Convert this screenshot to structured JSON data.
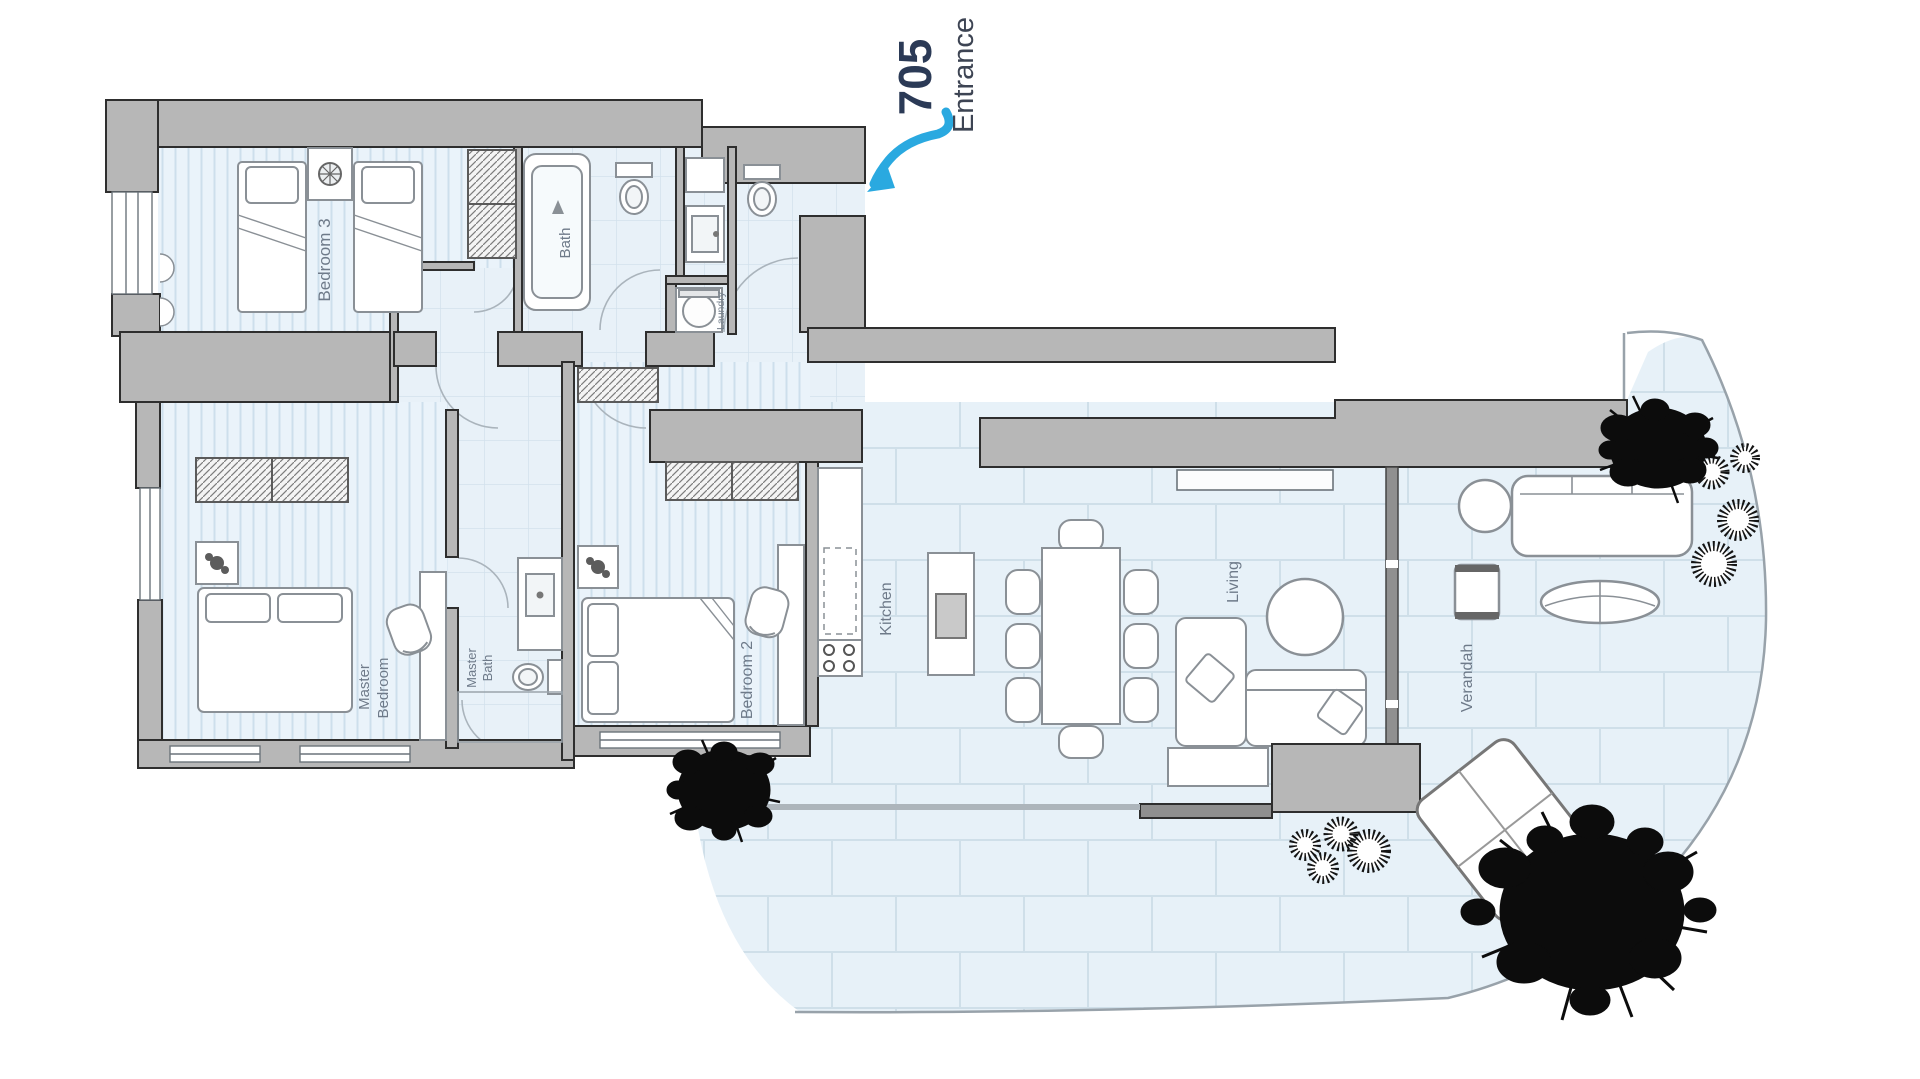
{
  "unit": {
    "number": "705",
    "entrance_label": "Entrance"
  },
  "rooms": {
    "bedroom3": {
      "label": "Bedroom 3"
    },
    "bath": {
      "label": "Bath"
    },
    "laundry": {
      "label": "Laundry"
    },
    "master_bedroom": {
      "line1": "Master",
      "line2": "Bedroom"
    },
    "master_bath": {
      "line1": "Master",
      "line2": "Bath"
    },
    "bedroom2": {
      "label": "Bedroom 2"
    },
    "kitchen": {
      "label": "Kitchen"
    },
    "living": {
      "label": "Living"
    },
    "verandah": {
      "label": "Verandah"
    }
  },
  "colors": {
    "wall_fill": "#b7b7b7",
    "wall_outline": "#2e2e2e",
    "floor": "#e9f2f8",
    "floor_line": "#cfe0ea",
    "accent_arrow": "#2aa9e0",
    "unit_number_text": "#2b3a56",
    "entrance_text": "#3d4453",
    "room_label_text": "#6e7a89",
    "tree": "#0c0c0c",
    "furniture_outline": "#8a9096"
  }
}
